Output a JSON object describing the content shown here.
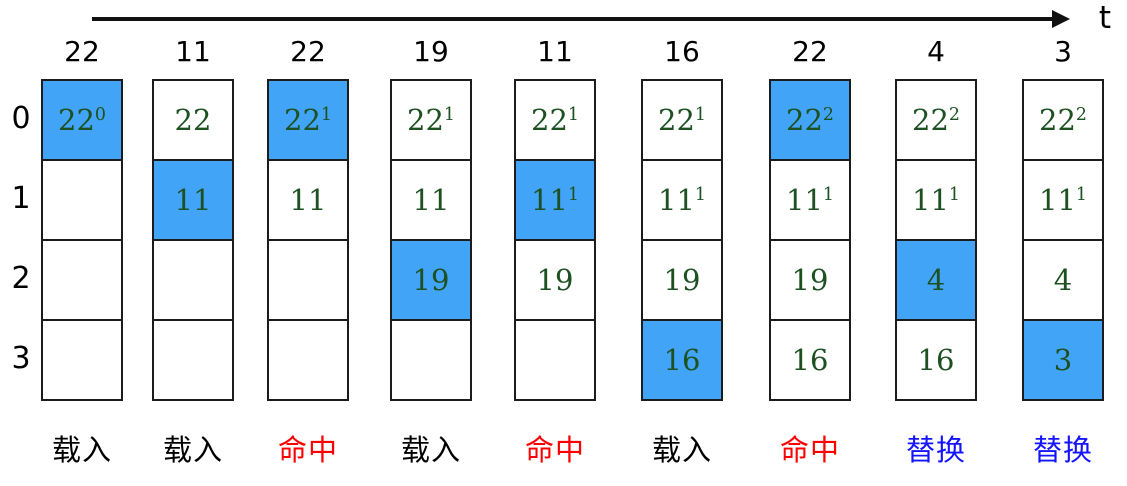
{
  "title": "LRU page replacement trace",
  "timeline": {
    "label": "t"
  },
  "row_labels": [
    "0",
    "1",
    "2",
    "3"
  ],
  "colors": {
    "highlight_fill": "#42A4F6",
    "cell_text": "#1d5122",
    "load_label": "#000000",
    "hit_label": "#FF0000",
    "replace_label": "#1414FF"
  },
  "action_labels": {
    "load": "载入",
    "hit": "命中",
    "replace": "替换"
  },
  "columns": [
    {
      "access": "22",
      "action": "load",
      "cells": [
        {
          "v": "22",
          "s": "0",
          "hl": true
        },
        null,
        null,
        null
      ]
    },
    {
      "access": "11",
      "action": "load",
      "cells": [
        {
          "v": "22"
        },
        {
          "v": "11",
          "hl": true
        },
        null,
        null
      ]
    },
    {
      "access": "22",
      "action": "hit",
      "cells": [
        {
          "v": "22",
          "s": "1",
          "hl": true
        },
        {
          "v": "11"
        },
        null,
        null
      ]
    },
    {
      "access": "19",
      "action": "load",
      "cells": [
        {
          "v": "22",
          "s": "1"
        },
        {
          "v": "11"
        },
        {
          "v": "19",
          "hl": true
        },
        null
      ]
    },
    {
      "access": "11",
      "action": "hit",
      "cells": [
        {
          "v": "22",
          "s": "1"
        },
        {
          "v": "11",
          "s": "1",
          "hl": true
        },
        {
          "v": "19"
        },
        null
      ]
    },
    {
      "access": "16",
      "action": "load",
      "cells": [
        {
          "v": "22",
          "s": "1"
        },
        {
          "v": "11",
          "s": "1"
        },
        {
          "v": "19"
        },
        {
          "v": "16",
          "hl": true
        }
      ]
    },
    {
      "access": "22",
      "action": "hit",
      "cells": [
        {
          "v": "22",
          "s": "2",
          "hl": true
        },
        {
          "v": "11",
          "s": "1"
        },
        {
          "v": "19"
        },
        {
          "v": "16"
        }
      ]
    },
    {
      "access": "4",
      "action": "replace",
      "cells": [
        {
          "v": "22",
          "s": "2"
        },
        {
          "v": "11",
          "s": "1"
        },
        {
          "v": "4",
          "hl": true
        },
        {
          "v": "16"
        }
      ]
    },
    {
      "access": "3",
      "action": "replace",
      "cells": [
        {
          "v": "22",
          "s": "2"
        },
        {
          "v": "11",
          "s": "1"
        },
        {
          "v": "4"
        },
        {
          "v": "3",
          "hl": true
        }
      ]
    }
  ]
}
